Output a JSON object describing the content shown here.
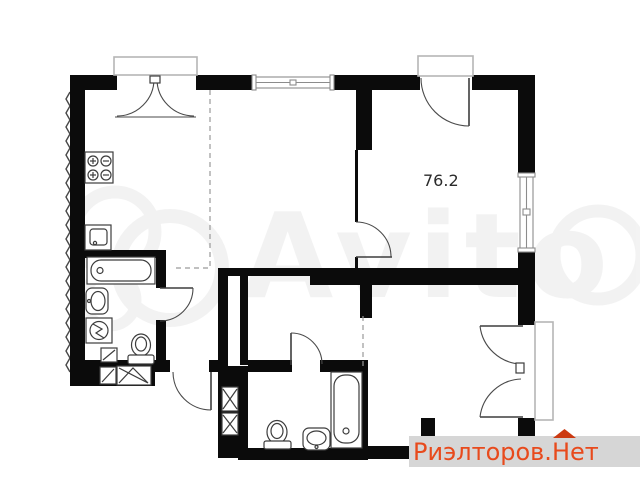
{
  "page": {
    "background_color": "#ffffff"
  },
  "floor_plan": {
    "area_label": "76.2",
    "wall_color": "#0b0b0b",
    "symbol_line_color": "#3d3d3d",
    "balcony_frame_color": "#b5b5b5",
    "dashed_line_color": "#9a9a9a",
    "fixtures": [
      "stove",
      "kitchen-sink",
      "bathtub",
      "vanity-sink",
      "washing-machine",
      "floor-drain",
      "toilet",
      "ventilation-shaft",
      "second-bathtub",
      "second-toilet",
      "second-vanity-sink"
    ],
    "features": [
      "balcony-door-top-left",
      "window-top",
      "balcony-door-top-right",
      "window-right",
      "balcony-door-bottom-right",
      "entry-door"
    ]
  },
  "watermarks": {
    "avito": {
      "text": "Avito",
      "color": "#1a1a1a",
      "opacity": "0.05"
    },
    "realtor": {
      "full_text": "Риэлторов.Нет",
      "text_before": "Риэлторов.",
      "accent_letter": "Н",
      "text_after": "ет",
      "text_color": "#e84a1c",
      "roof_color": "#cc3a12",
      "background_color": "#d6d6d6"
    }
  }
}
